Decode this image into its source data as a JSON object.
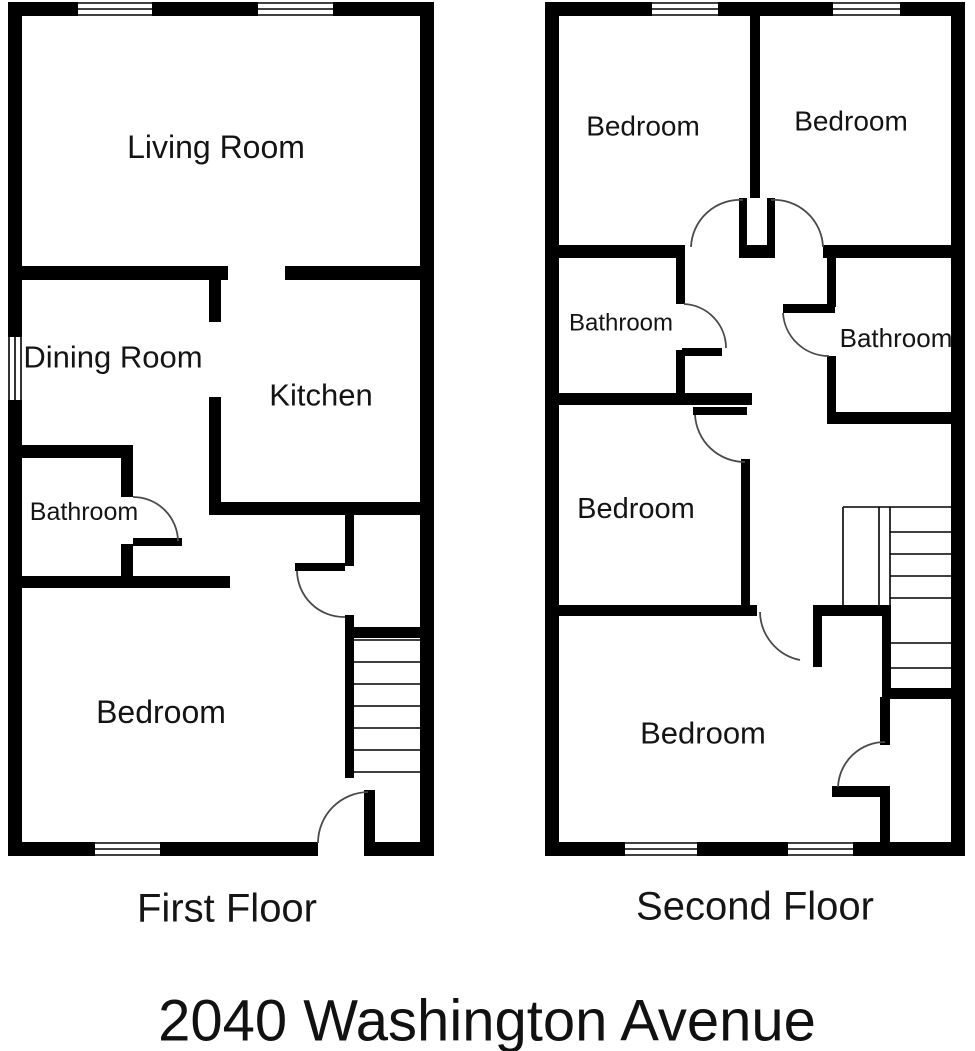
{
  "address": "2040 Washington Avenue",
  "colors": {
    "wall": "#000000",
    "bg": "#ffffff",
    "text": "#141414",
    "arc": "#4a4a4a"
  },
  "floors": [
    {
      "id": "first-floor",
      "title": "First Floor",
      "rooms": [
        {
          "name": "Living Room",
          "x": 216,
          "y": 147,
          "size": 32
        },
        {
          "name": "Dining Room",
          "x": 113,
          "y": 357,
          "size": 31
        },
        {
          "name": "Kitchen",
          "x": 321,
          "y": 395,
          "size": 31
        },
        {
          "name": "Bathroom",
          "x": 84,
          "y": 512,
          "size": 25
        },
        {
          "name": "Bedroom",
          "x": 161,
          "y": 712,
          "size": 32
        }
      ],
      "walls": [
        [
          8,
          2,
          426,
          14
        ],
        [
          8,
          842,
          310,
          14
        ],
        [
          364,
          842,
          70,
          14
        ],
        [
          8,
          2,
          14,
          854
        ],
        [
          420,
          2,
          14,
          854
        ],
        [
          8,
          266,
          220,
          14
        ],
        [
          285,
          266,
          149,
          14
        ],
        [
          209,
          278,
          12,
          44
        ],
        [
          209,
          397,
          12,
          110
        ],
        [
          209,
          502,
          225,
          13
        ],
        [
          345,
          512,
          9,
          54
        ],
        [
          295,
          563,
          50,
          8
        ],
        [
          345,
          615,
          9,
          163
        ],
        [
          345,
          627,
          89,
          11
        ],
        [
          8,
          445,
          125,
          13
        ],
        [
          121,
          445,
          12,
          52
        ],
        [
          133,
          538,
          49,
          8
        ],
        [
          121,
          544,
          12,
          44
        ],
        [
          8,
          576,
          222,
          12
        ],
        [
          364,
          790,
          11,
          55
        ]
      ],
      "windows": [
        {
          "x": 78,
          "y": 2,
          "w": 74,
          "h": 14,
          "orient": "h"
        },
        {
          "x": 258,
          "y": 2,
          "w": 75,
          "h": 14,
          "orient": "h"
        },
        {
          "x": 8,
          "y": 337,
          "w": 14,
          "h": 63,
          "orient": "v"
        },
        {
          "x": 95,
          "y": 842,
          "w": 65,
          "h": 14,
          "orient": "h"
        }
      ],
      "door_arcs": [
        "M 133 497 A 45 45 0 0 1 178 541",
        "M 297 571 A 47 47 0 0 0 345 617",
        "M 368 792 A 51 51 0 0 0 318 843"
      ],
      "stair_lines": [
        [
          354,
          640,
          420,
          640
        ],
        [
          354,
          662,
          420,
          662
        ],
        [
          354,
          684,
          420,
          684
        ],
        [
          354,
          706,
          420,
          706
        ],
        [
          354,
          728,
          420,
          728
        ],
        [
          354,
          750,
          420,
          750
        ],
        [
          354,
          772,
          420,
          772
        ]
      ]
    },
    {
      "id": "second-floor",
      "title": "Second Floor",
      "rooms": [
        {
          "name": "Bedroom",
          "x": 643,
          "y": 126,
          "size": 28
        },
        {
          "name": "Bedroom",
          "x": 851,
          "y": 121,
          "size": 28
        },
        {
          "name": "Bathroom",
          "x": 621,
          "y": 323,
          "size": 24
        },
        {
          "name": "Bathroom",
          "x": 896,
          "y": 338,
          "size": 26
        },
        {
          "name": "Bedroom",
          "x": 636,
          "y": 509,
          "size": 29
        },
        {
          "name": "Bedroom",
          "x": 703,
          "y": 733,
          "size": 31
        }
      ],
      "walls": [
        [
          545,
          2,
          420,
          14
        ],
        [
          545,
          842,
          420,
          14
        ],
        [
          545,
          2,
          14,
          854
        ],
        [
          951,
          2,
          14,
          854
        ],
        [
          750,
          2,
          10,
          196
        ],
        [
          739,
          198,
          8,
          49
        ],
        [
          767,
          198,
          8,
          49
        ],
        [
          739,
          245,
          36,
          13
        ],
        [
          545,
          245,
          140,
          13
        ],
        [
          823,
          245,
          142,
          13
        ],
        [
          676,
          258,
          9,
          46
        ],
        [
          682,
          348,
          40,
          8
        ],
        [
          676,
          350,
          9,
          50
        ],
        [
          545,
          393,
          207,
          12
        ],
        [
          827,
          250,
          9,
          57
        ],
        [
          783,
          304,
          52,
          9
        ],
        [
          827,
          356,
          9,
          60
        ],
        [
          827,
          412,
          138,
          12
        ],
        [
          741,
          459,
          9,
          151
        ],
        [
          693,
          407,
          54,
          8
        ],
        [
          545,
          605,
          212,
          11
        ],
        [
          813,
          605,
          78,
          11
        ],
        [
          813,
          605,
          9,
          62
        ],
        [
          882,
          605,
          9,
          92
        ],
        [
          888,
          688,
          77,
          11
        ],
        [
          880,
          697,
          10,
          48
        ],
        [
          832,
          786,
          58,
          11
        ],
        [
          880,
          797,
          10,
          49
        ]
      ],
      "windows": [
        {
          "x": 652,
          "y": 2,
          "w": 66,
          "h": 14,
          "orient": "h"
        },
        {
          "x": 833,
          "y": 2,
          "w": 67,
          "h": 14,
          "orient": "h"
        },
        {
          "x": 625,
          "y": 842,
          "w": 72,
          "h": 14,
          "orient": "h"
        },
        {
          "x": 788,
          "y": 842,
          "w": 65,
          "h": 14,
          "orient": "h"
        }
      ],
      "door_arcs": [
        "M 743 200 A 49 49 0 0 0 691 247",
        "M 771 200 A 49 49 0 0 1 823 247",
        "M 684 304 A 44 44 0 0 1 726 348",
        "M 783 313 A 46 46 0 0 0 829 356",
        "M 695 415 A 50 50 0 0 0 745 462",
        "M 760 612 A 50 50 0 0 0 800 660",
        "M 885 742 A 47 47 0 0 0 838 787"
      ],
      "stair_lines": [
        [
          843,
          507,
          951,
          507
        ],
        [
          843,
          507,
          843,
          605
        ],
        [
          879,
          507,
          879,
          605
        ],
        [
          890,
          507,
          890,
          605
        ],
        [
          890,
          532,
          951,
          532
        ],
        [
          890,
          554,
          951,
          554
        ],
        [
          890,
          576,
          951,
          576
        ],
        [
          890,
          598,
          951,
          598
        ],
        [
          891,
          643,
          951,
          643
        ],
        [
          891,
          668,
          951,
          668
        ]
      ]
    }
  ]
}
